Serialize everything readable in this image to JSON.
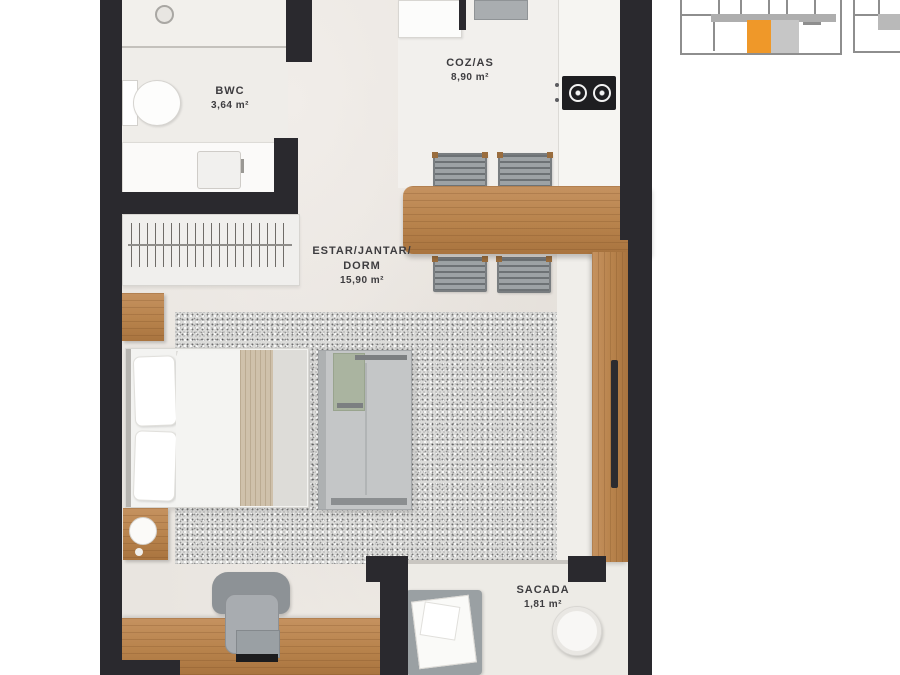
{
  "page": {
    "background": "#FFFFFF"
  },
  "floor_plan": {
    "rooms": [
      {
        "name": "BWC",
        "area": "3,64 m²"
      },
      {
        "name": "COZ/AS",
        "area": "8,90 m²"
      },
      {
        "name": "ESTAR/JANTAR/",
        "name_line2": "DORM",
        "area": "15,90 m²"
      },
      {
        "name": "SACADA",
        "area": "1,81 m²"
      }
    ],
    "colors": {
      "wall": "#2A292E",
      "wood": "#B8834C",
      "floor": "#E9E5E0",
      "rug": "#DCDCDA",
      "label_text": "#3D3C3F"
    }
  },
  "key_plan": {
    "highlight_color": "#EF9829",
    "outline_color": "#8E8E8E",
    "corridor_color": "#AEAEAE"
  }
}
